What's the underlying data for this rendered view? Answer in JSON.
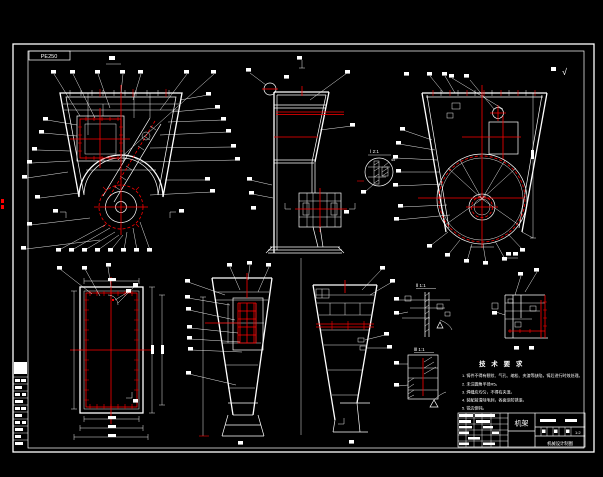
{
  "drawing": {
    "code_box": "PE250",
    "surface_finish_mark": "√",
    "labels": {
      "detail_b": "Ⅰ 2:1",
      "detail_d": "Ⅱ 1:1",
      "detail_e": "Ⅲ 1:1",
      "angle_note": "45°"
    },
    "notes": {
      "title": "技 术 要 求",
      "items": [
        "1. 铸件不得有裂纹、气孔、缩松、夹渣等缺陷，铸后进行时效处理。",
        "2. 未注圆角半径R5。",
        "3. 焊缝应均匀，不得有夹渣。",
        "4. 装配前清除毛刺，各面涂防锈漆。",
        "5. 锐边倒钝。"
      ]
    },
    "title_block": {
      "part_name": "机架",
      "scale": "1:2",
      "footer": "机械设计制图"
    },
    "colors": {
      "background": "#000000",
      "lines": "#ffffff",
      "accent": "#fe0000"
    }
  }
}
